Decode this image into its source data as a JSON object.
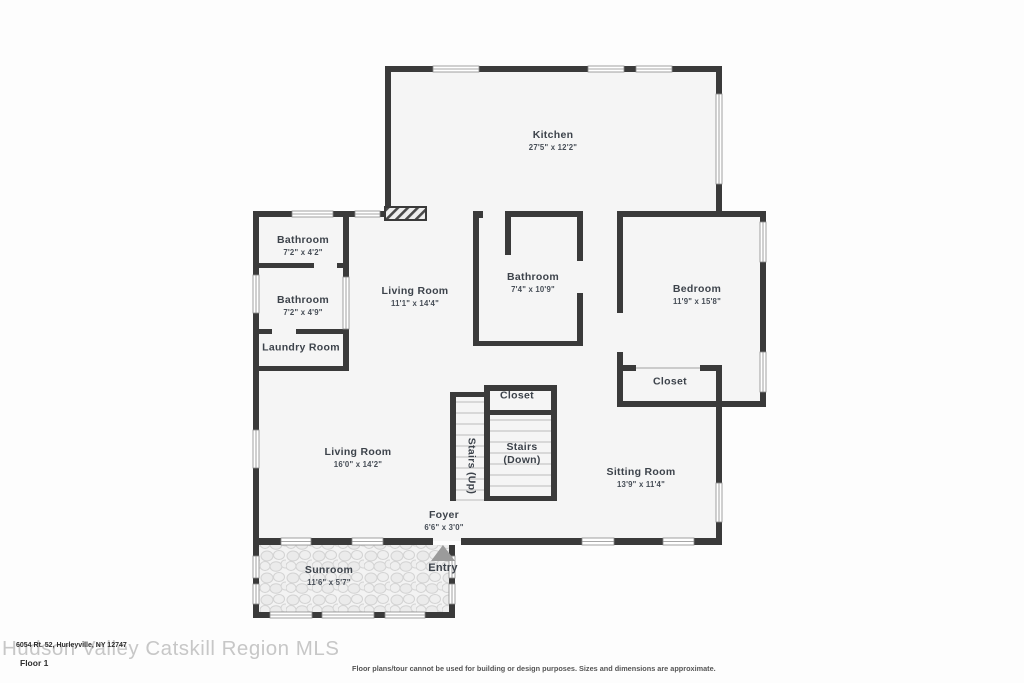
{
  "plan": {
    "rooms": {
      "kitchen": {
        "name": "Kitchen",
        "dims": "27'5\" x 12'2\""
      },
      "bathroom_top": {
        "name": "Bathroom",
        "dims": "7'2\" x 4'2\""
      },
      "bathroom_mid": {
        "name": "Bathroom",
        "dims": "7'2\" x 4'9\""
      },
      "laundry": {
        "name": "Laundry Room"
      },
      "living_upper": {
        "name": "Living Room",
        "dims": "11'1\" x 14'4\""
      },
      "bathroom_main": {
        "name": "Bathroom",
        "dims": "7'4\" x 10'9\""
      },
      "bedroom": {
        "name": "Bedroom",
        "dims": "11'9\" x 15'8\""
      },
      "bedroom_closet": {
        "name": "Closet"
      },
      "stairs_closet": {
        "name": "Closet"
      },
      "stairs_up": {
        "name": "Stairs (Up)"
      },
      "stairs_down": {
        "line1": "Stairs",
        "line2": "(Down)"
      },
      "living_lower": {
        "name": "Living Room",
        "dims": "16'0\" x 14'2\""
      },
      "sitting_room": {
        "name": "Sitting Room",
        "dims": "13'9\" x 11'4\""
      },
      "foyer": {
        "name": "Foyer",
        "dims": "6'6\" x 3'0\""
      },
      "sunroom": {
        "name": "Sunroom",
        "dims": "11'6\" x 5'7\""
      },
      "entry": {
        "label": "Entry"
      }
    }
  },
  "footer": {
    "watermark": "Hudson Valley Catskill Region MLS",
    "address": "6054 Rt. 52, Hurleyville, NY 12747",
    "floor_label": "Floor 1",
    "disclaimer": "Floor plans/tour cannot be used for building or design purposes. Sizes and dimensions are approximate."
  },
  "colors": {
    "wall": "#3a3a3a",
    "floor": "#f5f5f5",
    "window_line": "#8a8a8a",
    "text": "#3d434b",
    "entry_arrow": "#9b9b9b",
    "watermark": "#c7c7c7"
  }
}
